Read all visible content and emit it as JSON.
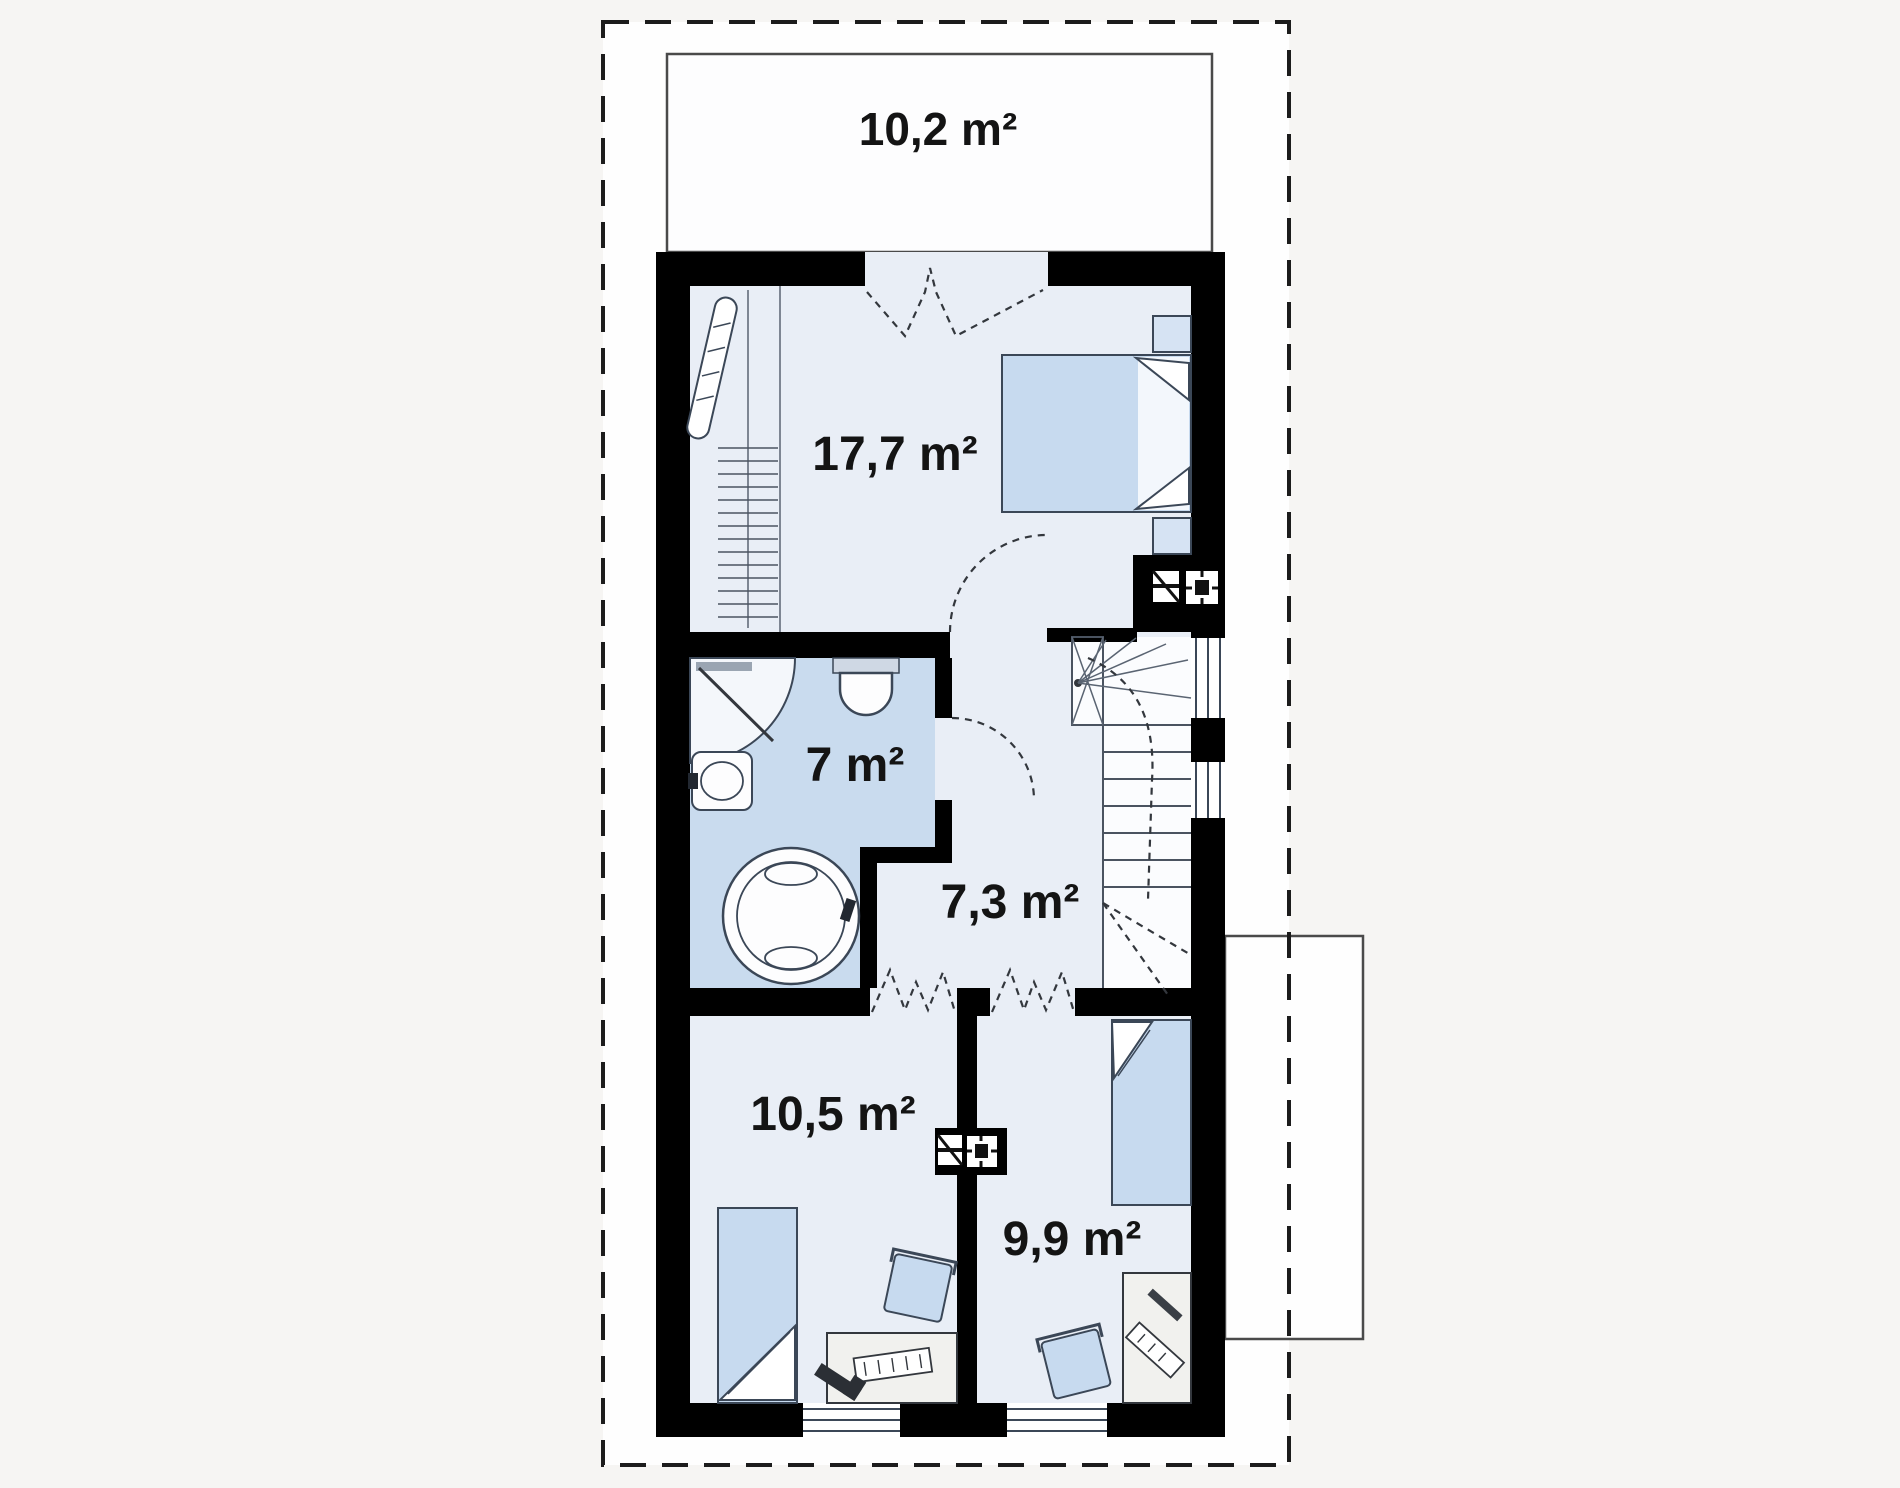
{
  "title": "Attic floor plan",
  "rooms": [
    {
      "id": "balcony",
      "area": "10,2 m²",
      "fixtures": [
        "balcony-deck"
      ]
    },
    {
      "id": "bedroom-main",
      "area": "17,7 m²",
      "fixtures": [
        "double-bed",
        "nightstand",
        "wardrobe",
        "mirror",
        "folding-balcony-door"
      ]
    },
    {
      "id": "bathroom",
      "area": "7 m²",
      "fixtures": [
        "corner-shower",
        "toilet",
        "washbasin",
        "round-bathtub"
      ]
    },
    {
      "id": "hall",
      "area": "7,3 m²",
      "fixtures": [
        "winder-staircase",
        "doors"
      ]
    },
    {
      "id": "bedroom-left",
      "area": "10,5 m²",
      "fixtures": [
        "single-bed",
        "desk",
        "chair",
        "folding-door",
        "window"
      ]
    },
    {
      "id": "bedroom-right",
      "area": "9,9 m²",
      "fixtures": [
        "single-bed",
        "desk",
        "chair",
        "folding-door",
        "window"
      ]
    }
  ],
  "icons": {
    "chimney_flue": "black block with white flue squares",
    "window": "white gap with triple parallel lines",
    "door_swing": "dashed quarter arc",
    "folding_door": "dashed zigzag",
    "stair_direction": "dashed flight lines"
  },
  "colors": {
    "page_bg": "#f6f5f3",
    "site_bg": "#fefefe",
    "wall": "#000000",
    "floor": "#e9eef6",
    "bath": "#c9dbee",
    "stair": "#fbfcfe",
    "furn": "#c7daef",
    "desk": "#f1f1ee",
    "outline": "#3b4757",
    "label": "#141414",
    "boundary": "#1c1c1c"
  }
}
